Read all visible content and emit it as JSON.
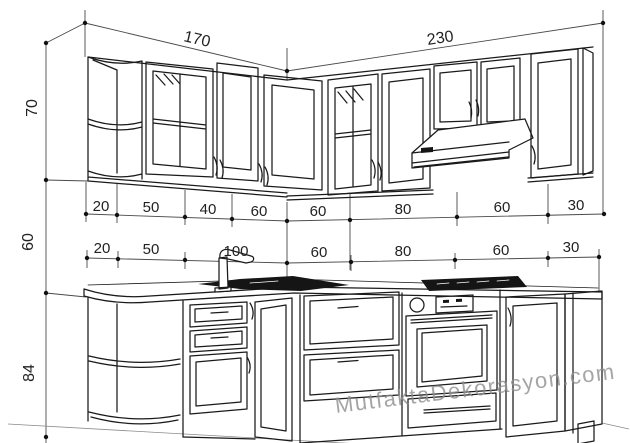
{
  "page": {
    "description": "Perspective line drawing of an L-shaped kitchen (wall and base cabinets) with centimeter dimensions"
  },
  "dimensions": {
    "top_widths": [
      "170",
      "230"
    ],
    "left_heights": [
      "70",
      "60",
      "84"
    ],
    "wall_cabinet_segments": [
      "20",
      "50",
      "40",
      "60",
      "60",
      "80",
      "60",
      "30"
    ],
    "base_cabinet_segments": [
      "20",
      "50",
      "100",
      "60",
      "80",
      "60",
      "30"
    ]
  },
  "watermark": {
    "text": "MutfaktaDekorasyon.com",
    "color": "#8f8f8f"
  },
  "colors": {
    "line": "#1a1a1a",
    "dimension_line": "#4a4a4a",
    "label": "#222222",
    "dark_fill": "#151515",
    "background": "#ffffff"
  }
}
